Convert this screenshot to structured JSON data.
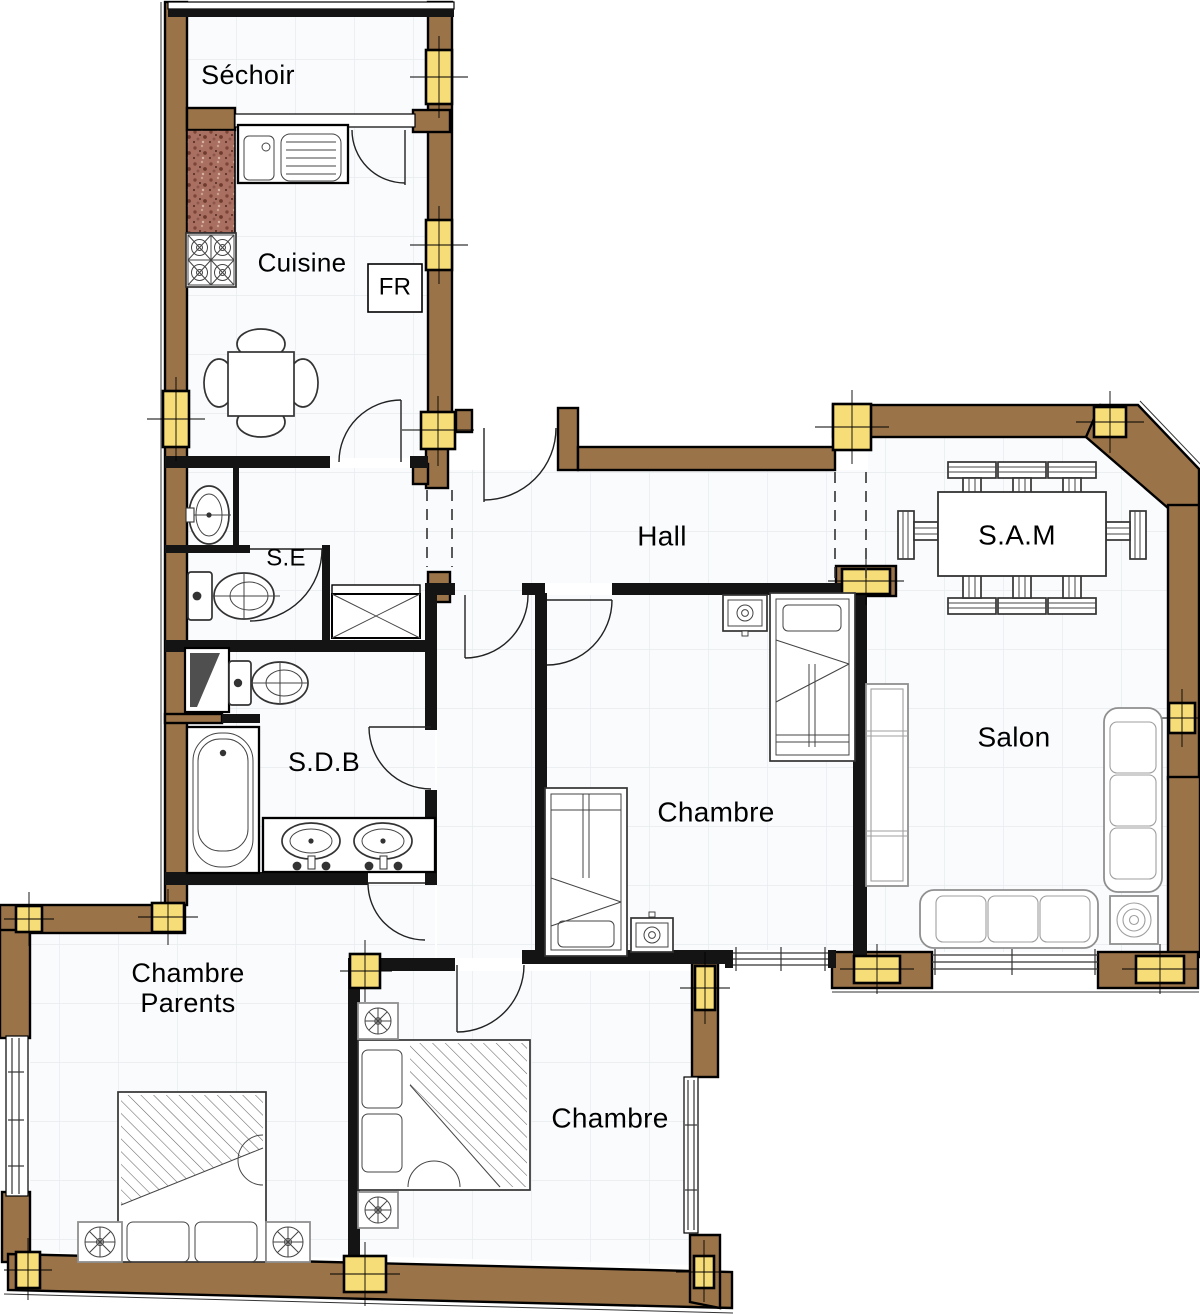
{
  "plan": {
    "colors": {
      "wall": "#9a7349",
      "wall-dark": "#141414",
      "column": "#f7dd78",
      "floor-line": "#e8ebef",
      "granite": "#a97062",
      "shaft": "#4f4f4f"
    },
    "rooms": {
      "sechoir": {
        "label": "Séchoir"
      },
      "cuisine": {
        "label": "Cuisine"
      },
      "fridge": {
        "label": "FR"
      },
      "se": {
        "label": "S.E"
      },
      "hall": {
        "label": "Hall"
      },
      "sam": {
        "label": "S.A.M"
      },
      "sdb": {
        "label": "S.D.B"
      },
      "chambre_middle": {
        "label": "Chambre"
      },
      "salon": {
        "label": "Salon"
      },
      "chambre_parents": {
        "label": "Chambre Parents"
      },
      "chambre_bottom": {
        "label": "Chambre"
      }
    }
  }
}
